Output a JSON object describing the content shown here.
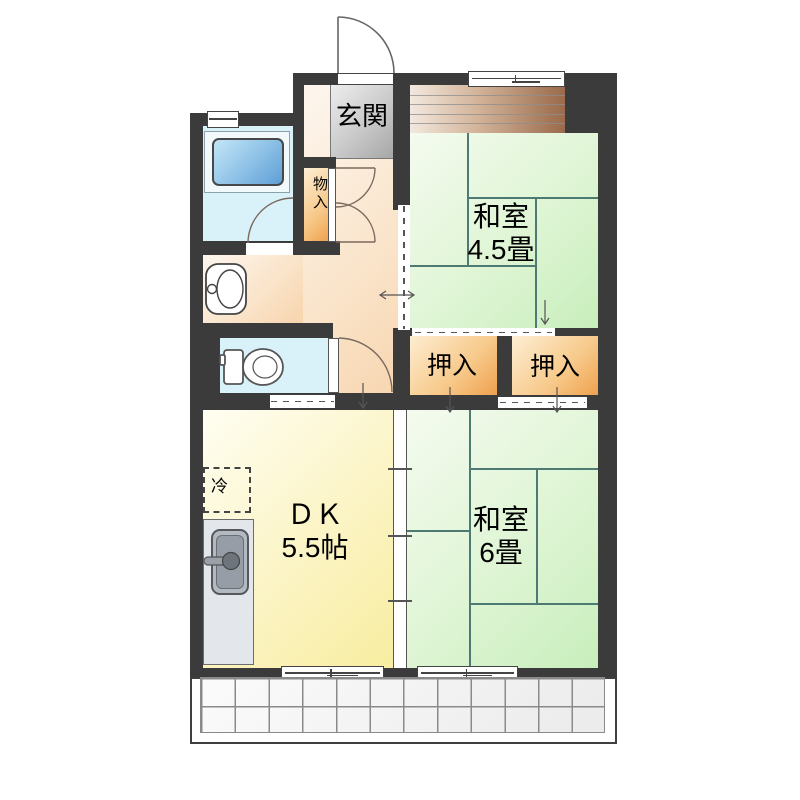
{
  "plan_type": "apartment-floor-plan",
  "rooms": {
    "genkan": {
      "label": "玄関"
    },
    "monoire": {
      "label": "物入"
    },
    "washitsu45": {
      "name": "和室",
      "size": "4.5畳"
    },
    "washitsu6": {
      "name": "和室",
      "size": "6畳"
    },
    "dk": {
      "name": "ＤＫ",
      "size": "5.5帖"
    },
    "oshiire1": {
      "label": "押入"
    },
    "oshiire2": {
      "label": "押入"
    },
    "refrigerator": {
      "label": "冷"
    }
  },
  "fixtures": {
    "bathtub": "bathtub-icon",
    "toilet": "toilet-icon",
    "washbasin": "washbasin-icon",
    "kitchen_sink": "kitchen-sink-icon",
    "entrance_door": "door-swing-arc",
    "balcony": "tiled-balcony"
  },
  "colors": {
    "wall": "#3b3b3b",
    "tatami": "#d8f2cc",
    "tatami_line": "#4d7a72",
    "closet_orange": "#f2a855",
    "hall_peach": "#f9dfc0",
    "dk_yellow": "#faf0a8",
    "water_blue": "#d9f2fa",
    "bathtub_blue": "#5f9fd6",
    "genkan_gray": "#b5b5b5",
    "veranda_brown": "#9a6a4a",
    "balcony_tile": "#f3f3f3"
  }
}
